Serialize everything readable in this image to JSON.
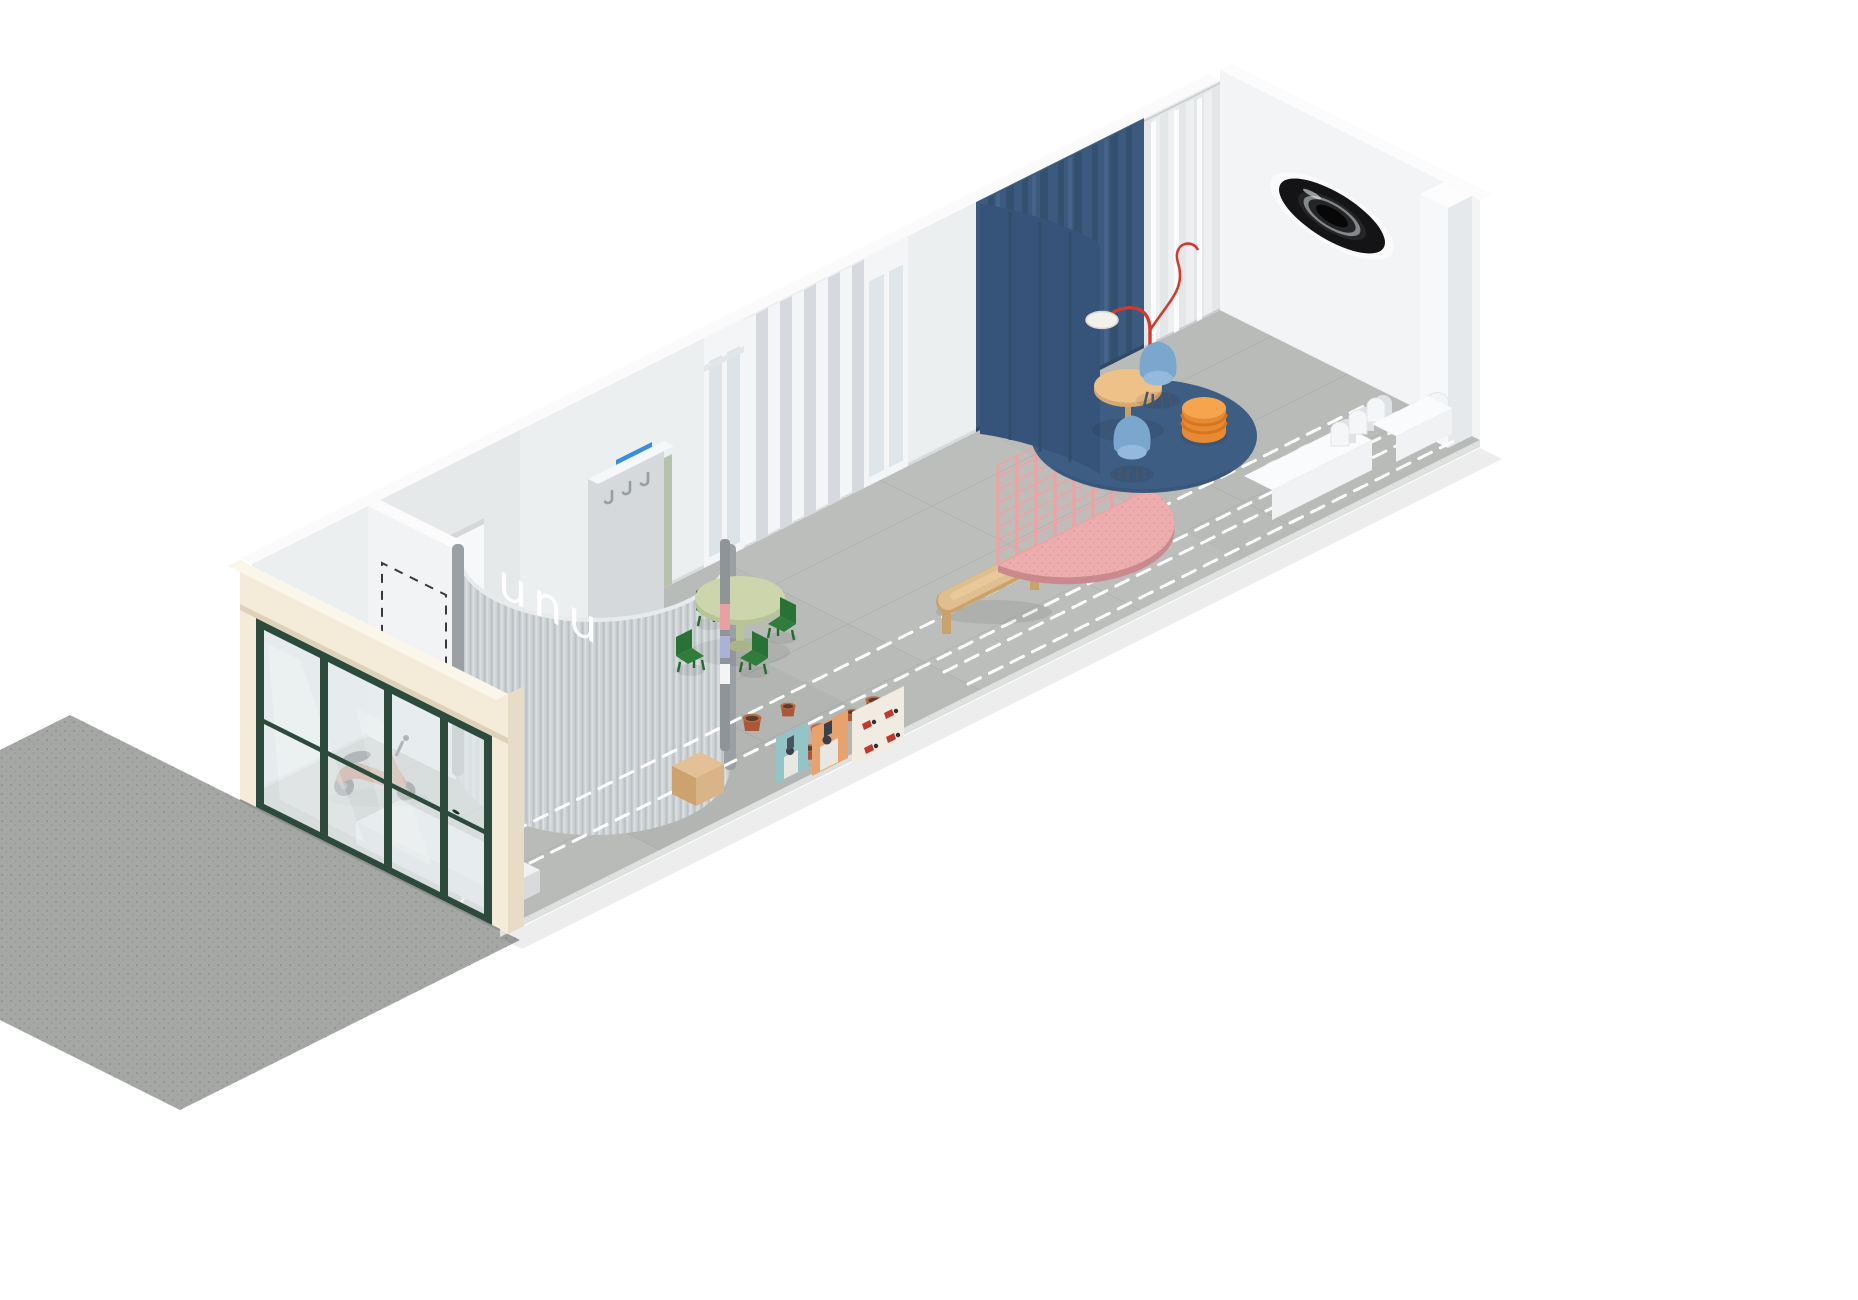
{
  "scene": {
    "brand": "unu"
  },
  "colors": {
    "cream": "#f4ecd9",
    "cream_shade": "#e7dcc5",
    "frame_green": "#2d4b3c",
    "glass": "#e3eaec",
    "floor": "#b9bbb8",
    "sidewalk": "#a5a7a5",
    "wall": "#eceff0",
    "wall_shade": "#d8dcde",
    "corrugation": "#ced3d5",
    "corrugation_rib": "#b9bfc2",
    "navy": "#3c5a7d",
    "navy_dark": "#33506e",
    "rug_navy": "#3e5d82",
    "panel_azure": "#3a8edd",
    "panel_blush": "#e59a9b",
    "panel_sage": "#b7c2ad",
    "chair_green": "#2f7c3b",
    "table_green": "#ccd5ab",
    "terracotta": "#ad5739",
    "wood": "#e0be8f",
    "wood_block": "#d9b488",
    "chair_blue": "#7ba7cf",
    "stool_orange": "#e78a33",
    "lamp_red": "#cf3b31",
    "pink_platform": "#edadaf",
    "pink_grid": "#f2a0a4",
    "route_dash": "#ffffff",
    "porthole_black": "#141416"
  }
}
